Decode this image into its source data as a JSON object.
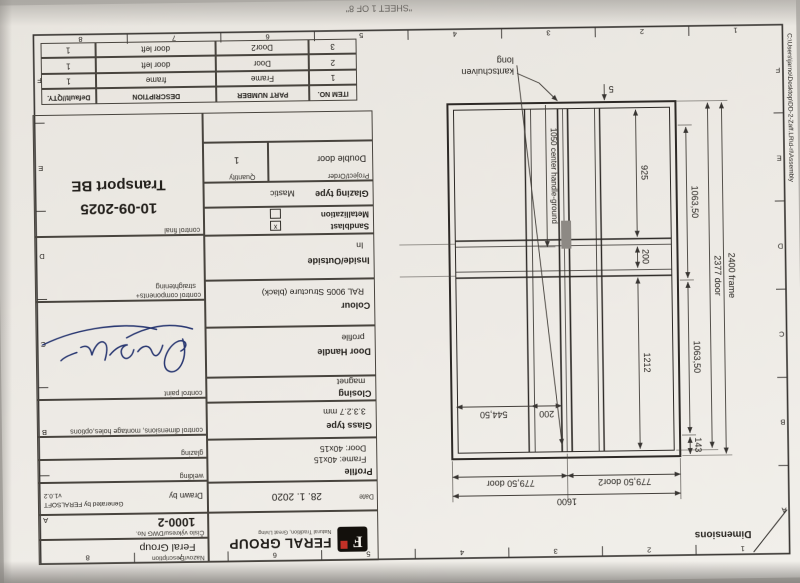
{
  "sheet": {
    "sheet_label": "\"SHEET 1 OF 8\"",
    "file_path": "C:\\Users\\jarno\\Desktop\\DD-2-Zaff.LR\\d-rl\\Assembly",
    "view_label": "Dimensions"
  },
  "border": {
    "columns": [
      "1",
      "2",
      "3",
      "4",
      "5",
      "6",
      "7",
      "8"
    ],
    "rows": [
      "A",
      "B",
      "C",
      "D",
      "E",
      "F"
    ]
  },
  "title_block": {
    "company": {
      "name": "FERAL GROUP",
      "tagline": "Natural Tradition, Great Living",
      "logo_letter": "F"
    },
    "date": {
      "label": "Date",
      "value": "28. 1. 2020"
    },
    "drawn_by": {
      "label": "Drawn by",
      "value_line1": "Generated by FERALSOFT",
      "value_line2": "v1.0.2"
    },
    "description": {
      "label": "Nazov/Description",
      "value": "Feral Group"
    },
    "dwg_no": {
      "label": "Číslo výkresu/DWG No.",
      "value": "1000-2"
    },
    "profile": {
      "label": "Profile",
      "value_line1": "Frame: 40x15",
      "value_line2": "Door: 40x15"
    },
    "glass_type": {
      "label": "Glass type",
      "value": "3.3.2.7 mm"
    },
    "closing": {
      "label": "Closing",
      "value": "magnet"
    },
    "door_handle": {
      "label": "Door Handle",
      "value": "profile"
    },
    "colour": {
      "label": "Colour",
      "value": "RAL 9005 Structure (black)"
    },
    "inside_outside": {
      "label": "Inside/Outside",
      "value": "In"
    },
    "sandblast": {
      "label": "Sandblast",
      "check": "x"
    },
    "metallization": {
      "label": "Metallization",
      "check": ""
    },
    "glazing_type": {
      "label": "Glazing type",
      "value": "Mastic"
    },
    "project_order": {
      "label": "Project/Order",
      "value": "Double door"
    },
    "quantity": {
      "label": "Quantity",
      "value": "1"
    },
    "controls": {
      "welding": "welding",
      "glazing": "glazing",
      "dimensions": "control dimensions, montage holes,options",
      "paint": "control paint",
      "components_line1": "control components+",
      "components_line2": "straightening",
      "final": "control final"
    },
    "stamp": {
      "date": "10-09-2025",
      "dest": "Transport BE"
    }
  },
  "parts_table": {
    "headers": [
      "ITEM NO.",
      "PART NUMBER",
      "DESCRIPTION",
      "Default//QTY."
    ],
    "rows": [
      {
        "item_no": "1",
        "part_number": "Frame",
        "description": "frame",
        "qty": "1"
      },
      {
        "item_no": "2",
        "part_number": "Door",
        "description": "door left",
        "qty": "1"
      },
      {
        "item_no": "3",
        "part_number": "Door2",
        "description": "door left",
        "qty": "1"
      }
    ]
  },
  "drawing": {
    "callout_line1": "kantschuiven",
    "callout_line2": "long",
    "dims": {
      "gap5": "5",
      "h925": "925",
      "h200": "200",
      "h1212": "1212",
      "h143": "143",
      "g1063a": "1063,50",
      "g1063b": "1063,50",
      "door_h": "2377 door",
      "frame_h": "2400 frame",
      "w200": "200",
      "w544": "544,50",
      "door_w": "779,50 door",
      "door2_w": "779,50 door2",
      "total_w": "1600",
      "handle": "1050 center handle-ground"
    }
  }
}
